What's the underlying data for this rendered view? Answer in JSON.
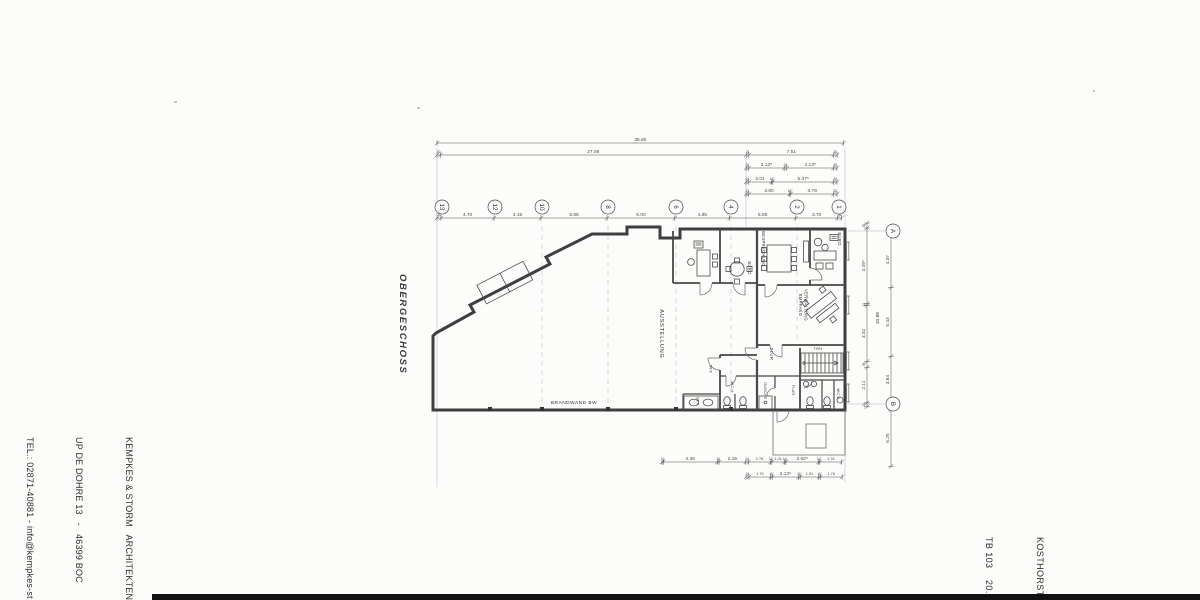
{
  "side_labels": {
    "floor": "OBERGESCHOSS"
  },
  "title_block": {
    "architect": [
      "KEMPKES & STORM   ARCHITEKTEN",
      "UP DE DOHRE 13   -   46399 BOC",
      "TEL.: 02871-40881 - info@kempkes-st"
    ],
    "project": [
      "KOSTHORST",
      "TB 103    20.0"
    ]
  },
  "colors": {
    "wall": "#3f3f3f",
    "thin_line": "#6a6a6a",
    "dimension": "#4a4a4a",
    "grid_line": "#b5b5b5",
    "paper": "#fcfcfb",
    "scan_strip": "#121212"
  },
  "plan": {
    "room_labels": [
      {
        "t": "AUSSTELLUNG",
        "x": 660,
        "y": 334,
        "r": 90,
        "s": 5.5,
        "ls": 0.8
      },
      {
        "t": "BÜRO",
        "x": 748,
        "y": 268,
        "r": 90,
        "s": 4.2,
        "ls": 0.3
      },
      {
        "t": "BESPRECHUNG",
        "x": 762,
        "y": 249,
        "r": 90,
        "s": 4.2,
        "ls": 0.3
      },
      {
        "t": "BÜRO",
        "x": 838,
        "y": 239,
        "r": 90,
        "s": 4.2,
        "ls": 0.3
      },
      {
        "t": "EMPFANG",
        "x": 799,
        "y": 305,
        "r": 90,
        "s": 4.2,
        "ls": 0.3
      },
      {
        "t": "VERWALTUNG",
        "x": 804.5,
        "y": 305,
        "r": 90,
        "s": 4.2,
        "ls": 0.3
      },
      {
        "t": "FLUR",
        "x": 770,
        "y": 354,
        "r": 90,
        "s": 4.2,
        "ls": 0.3
      },
      {
        "t": "TRH",
        "x": 818,
        "y": 350,
        "r": 0,
        "s": 3.8,
        "ls": 0.3
      },
      {
        "t": "WC H",
        "x": 731,
        "y": 387,
        "r": 90,
        "s": 3.8,
        "ls": 0.2
      },
      {
        "t": "DUSCHE",
        "x": 764,
        "y": 391,
        "r": 90,
        "s": 3.8,
        "ls": 0.2
      },
      {
        "t": "FLUR",
        "x": 792,
        "y": 390,
        "r": 90,
        "s": 3.8,
        "ls": 0.2
      },
      {
        "t": "WC D",
        "x": 837,
        "y": 394,
        "r": 90,
        "s": 3.8,
        "ls": 0.2
      },
      {
        "t": "BRANDWAND BW",
        "x": 574,
        "y": 404,
        "r": 0,
        "s": 4.8,
        "ls": 0.5
      },
      {
        "t": "10.88",
        "x": 879,
        "y": 318,
        "r": -90,
        "s": 4.5,
        "ls": 0.2
      },
      {
        "t": "3.86",
        "x": 712,
        "y": 369,
        "r": -90,
        "s": 3.8,
        "ls": 0.1
      },
      {
        "t": "1.50",
        "x": 699,
        "y": 401,
        "r": -90,
        "s": 3.6,
        "ls": 0.1
      }
    ],
    "grid_bubbles": [
      {
        "label": "13",
        "x": 442,
        "y": 207
      },
      {
        "label": "12",
        "x": 495,
        "y": 207
      },
      {
        "label": "10",
        "x": 542,
        "y": 207
      },
      {
        "label": "8",
        "x": 608,
        "y": 207
      },
      {
        "label": "6",
        "x": 676,
        "y": 207
      },
      {
        "label": "4",
        "x": 731,
        "y": 207
      },
      {
        "label": "2",
        "x": 797,
        "y": 207
      },
      {
        "label": "1",
        "x": 839,
        "y": 207
      },
      {
        "label": "A",
        "x": 893,
        "y": 231
      },
      {
        "label": "B",
        "x": 893,
        "y": 404
      }
    ],
    "dim_chains": [
      {
        "x": 437,
        "y": 143,
        "dir": "h",
        "scale": 11.36,
        "segs": [
          [
            "35.80",
            35.8
          ]
        ]
      },
      {
        "x": 437,
        "y": 155,
        "dir": "h",
        "scale": 11.3,
        "segs": [
          [
            "30",
            0.3
          ],
          [
            "27.06",
            27.06
          ],
          [
            "24",
            0.24
          ],
          [
            "7.51",
            7.51
          ],
          [
            "30",
            0.3
          ]
        ]
      },
      {
        "x": 746,
        "y": 168,
        "dir": "h",
        "scale": 11.3,
        "segs": [
          [
            "24",
            0.24
          ],
          [
            "3.13⁵",
            3.135
          ],
          [
            "24",
            0.24
          ],
          [
            "4.13⁵",
            4.135
          ],
          [
            "30",
            0.3
          ]
        ]
      },
      {
        "x": 746,
        "y": 182,
        "dir": "h",
        "scale": 11.3,
        "segs": [
          [
            "24",
            0.24
          ],
          [
            "2.01",
            2.01
          ],
          [
            "12⁵",
            0.125
          ],
          [
            "5.37⁵",
            5.375
          ],
          [
            "30",
            0.3
          ]
        ]
      },
      {
        "x": 746,
        "y": 194,
        "dir": "h",
        "scale": 11.3,
        "segs": [
          [
            "24",
            0.24
          ],
          [
            "3.60",
            3.6
          ],
          [
            "12⁵",
            0.125
          ],
          [
            "3.79",
            3.79
          ],
          [
            "30",
            0.3
          ]
        ]
      },
      {
        "x": 437,
        "y": 218,
        "dir": "h",
        "scale": 11.3,
        "segs": [
          [
            "35",
            0.35
          ],
          [
            "4.70",
            4.7
          ],
          [
            "4.15",
            4.15
          ],
          [
            "5.85",
            5.85
          ],
          [
            "6.00",
            6.0
          ],
          [
            "4.85",
            4.85
          ],
          [
            "5.85",
            5.85
          ],
          [
            "3.70",
            3.7
          ],
          [
            "35",
            0.35
          ]
        ]
      },
      {
        "x": 662,
        "y": 462,
        "dir": "h",
        "scale": 12.4,
        "segs": [
          [
            "10",
            0.1
          ],
          [
            "4.35",
            4.35
          ],
          [
            "15",
            0.15
          ],
          [
            "2.15",
            2.15
          ],
          [
            "24",
            0.24
          ],
          [
            "1.76",
            1.76
          ],
          [
            "11⁵",
            0.115
          ],
          [
            "1.01",
            1.01
          ],
          [
            "11⁵",
            0.115
          ],
          [
            "2.62⁵",
            2.625
          ],
          [
            "11⁵",
            0.115
          ],
          [
            "1.76",
            1.76
          ]
        ]
      },
      {
        "x": 746,
        "y": 477,
        "dir": "h",
        "scale": 12.4,
        "segs": [
          [
            "24",
            0.24
          ],
          [
            "1.76",
            1.76
          ],
          [
            "11⁵",
            0.115
          ],
          [
            "2.13⁵",
            2.135
          ],
          [
            "11⁵",
            0.115
          ],
          [
            "1.51",
            1.51
          ],
          [
            "11⁵",
            0.115
          ],
          [
            "1.76",
            1.76
          ]
        ]
      },
      {
        "x": 867,
        "y": 223,
        "dir": "v",
        "scale": 16.8,
        "segs": [
          [
            "30",
            0.3
          ],
          [
            "4.49⁵",
            4.495
          ],
          [
            "12",
            0.12
          ],
          [
            "3.32",
            3.32
          ],
          [
            "36",
            0.36
          ],
          [
            "2.11",
            2.11
          ],
          [
            "24",
            0.24
          ]
        ]
      },
      {
        "x": 891,
        "y": 232,
        "dir": "v",
        "scale": 12.7,
        "segs": [
          [
            "4.37",
            4.37
          ],
          [
            "5.43",
            5.43
          ],
          [
            "3.64",
            3.64
          ]
        ]
      },
      {
        "x": 891,
        "y": 410,
        "dir": "v",
        "scale": 9.0,
        "segs": [
          [
            "6.25",
            6.25
          ]
        ]
      }
    ]
  }
}
